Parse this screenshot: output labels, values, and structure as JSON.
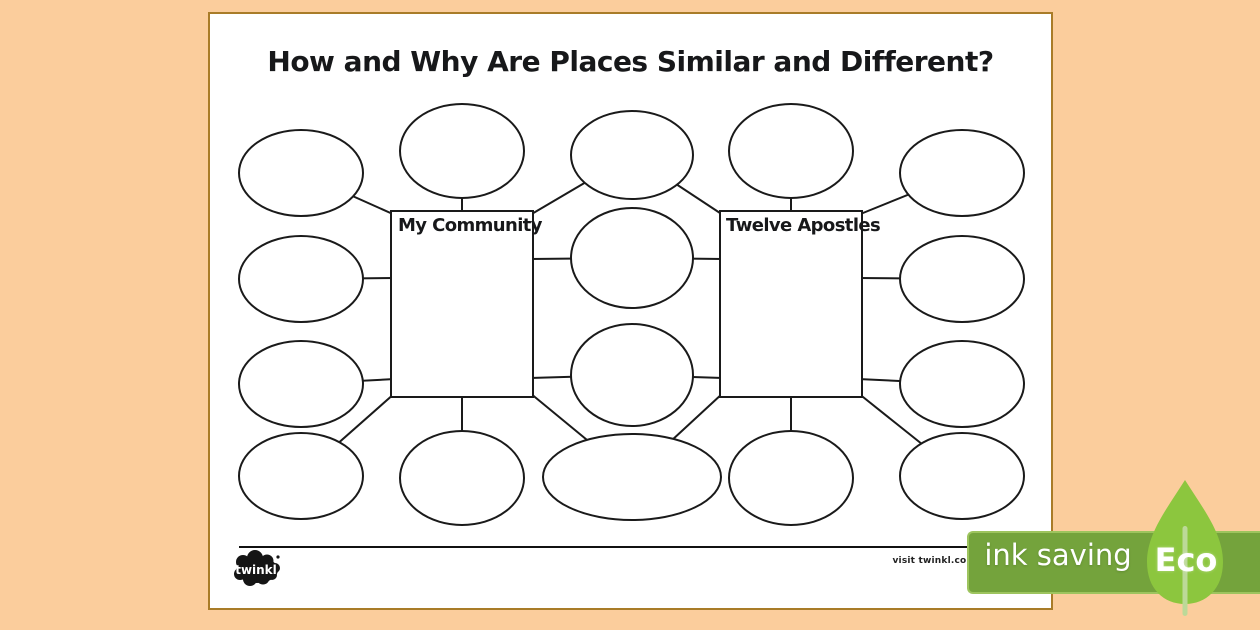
{
  "page": {
    "title": "How and Why Are Places Similar and Different?",
    "background_color": "#ffffff",
    "border_color": "#a97c28",
    "canvas_background": "#fbcd9c"
  },
  "diagram": {
    "left_box": {
      "label": "My Community"
    },
    "right_box": {
      "label": "Twelve Apostles"
    },
    "ovals": {
      "left_column_count": 4,
      "right_column_count": 4,
      "middle_shared_count": 4,
      "above_left_box_count": 1,
      "below_left_box_count": 1,
      "above_right_box_count": 1,
      "below_right_box_count": 1,
      "total": 14
    },
    "line_color": "#1a1a1a"
  },
  "footer": {
    "logo_text": "twinkl",
    "visit_text": "visit twinkl.com"
  },
  "eco_badge": {
    "label": "ink saving",
    "eco_label": "Eco",
    "banner_color": "#74a33c",
    "banner_border_color": "#9dc45e",
    "leaf_color": "#8cc63e",
    "stem_color": "#bcd998"
  }
}
